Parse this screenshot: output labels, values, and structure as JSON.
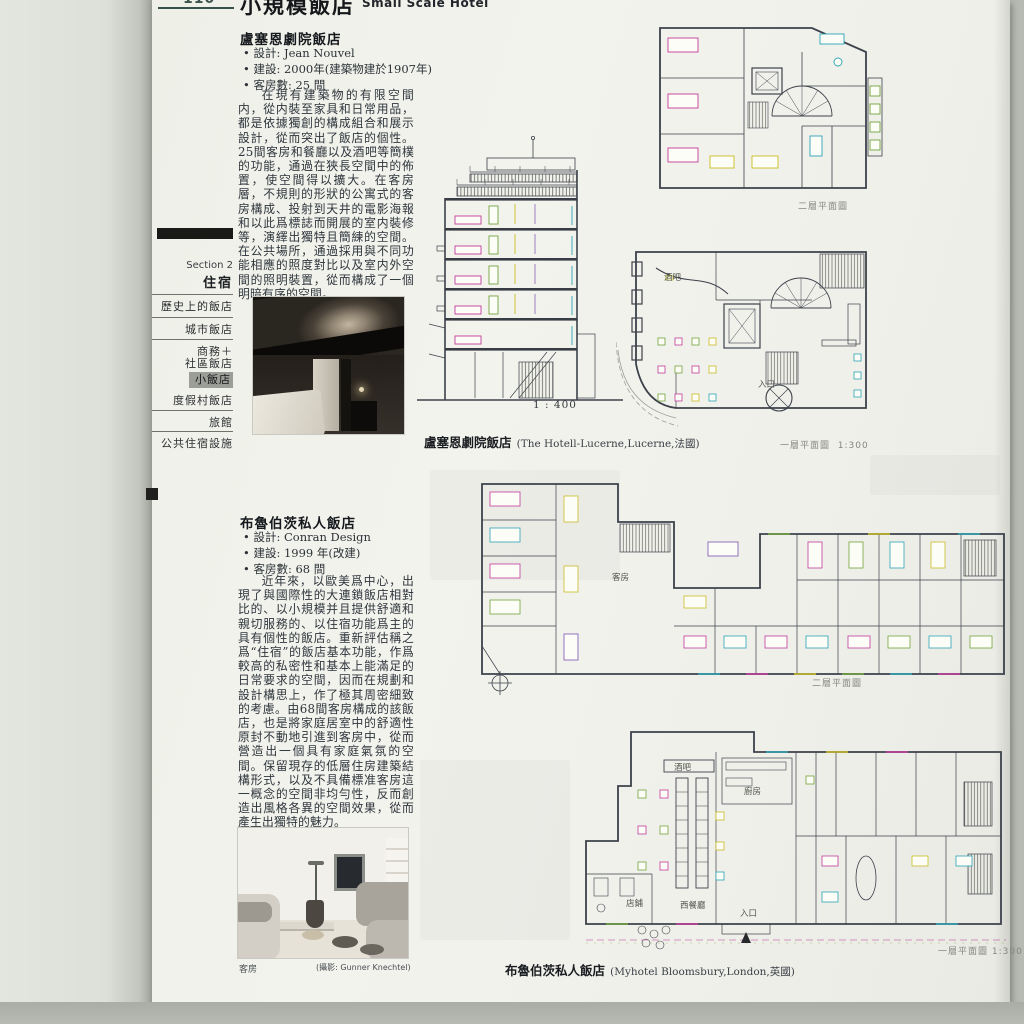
{
  "page": {
    "number": "110",
    "title_cn": "小規模飯店",
    "title_en": "Small Scale Hotel"
  },
  "sidebar": {
    "section": "Section 2",
    "section_title": "住宿",
    "items": [
      {
        "label": "歷史上的飯店"
      },
      {
        "label": "城市飯店"
      },
      {
        "label": "商務＋",
        "label2": "社區飯店"
      },
      {
        "label": "小飯店"
      },
      {
        "label": "度假村飯店"
      },
      {
        "label": "旅館"
      },
      {
        "label": "公共住宿設施"
      }
    ]
  },
  "article1": {
    "title": "盧塞恩劇院飯店",
    "specs": [
      "• 設計: Jean Nouvel",
      "• 建設: 2000年(建築物建於1907年)",
      "• 客房數: 25 間"
    ],
    "body": "在現有建築物的有限空間内，從内裝至家具和日常用品，都是依據獨創的構成組合和展示設計，從而突出了飯店的個性。25間客房和餐廳以及酒吧等簡樸的功能，通過在狹長空間中的佈置，使空間得以擴大。在客房層，不規則的形狀的公寓式的客房構成、投射到天井的電影海報和以此爲標誌而開展的室内裝修等，演繹出獨特且簡練的空間。在公共場所，通過採用與不同功能相應的照度對比以及室内外空間的照明裝置，從而構成了一個明暗有序的空間。",
    "section_scale": "1 : 400",
    "caption_cn": "盧塞恩劇院飯店",
    "caption_en": "(The Hotell-Lucerne,Lucerne,法國)",
    "plan2_label": "二層平面圖",
    "plan1_label": "一層平面圖",
    "plan1_scale": "1:300",
    "plan_labels": {
      "bar": "酒吧",
      "entrance": "入口"
    }
  },
  "article2": {
    "title": "布魯伯茨私人飯店",
    "specs": [
      "• 設計: Conran Design",
      "• 建設: 1999 年(改建)",
      "• 客房數: 68 間"
    ],
    "body": "近年來，以歐美爲中心，出現了與國際性的大連鎖飯店相對比的、以小規模并且提供舒適和親切服務的、以住宿功能爲主的具有個性的飯店。重新評估稱之爲“住宿”的飯店基本功能，作爲較高的私密性和基本上能滿足的日常要求的空間，因而在規劃和設計構思上，作了極其周密細致的考慮。由68間客房構成的該飯店，也是將家庭居室中的舒適性原封不動地引進到客房中，從而營造出一個具有家庭氣氛的空間。保留現存的低層住房建築結構形式，以及不具備標准客房這一概念的空間非均勻性，反而創造出風格各異的空間效果，從而產生出獨特的魅力。",
    "photo_caption_left": "客房",
    "photo_caption_right": "(攝影: Gunner Knechtel)",
    "caption_cn": "布魯伯茨私人飯店",
    "caption_en": "(Myhotel Bloomsbury,London,英國)",
    "plan2_label": "二層平面圖",
    "plan1_label": "一層平面圖",
    "plan1_scale": "1:300",
    "plan_labels": {
      "guestroom": "客房",
      "bar": "酒吧",
      "kitchen": "廚房",
      "shop": "店鋪",
      "restaurant": "西餐廳",
      "entrance": "入口"
    }
  }
}
